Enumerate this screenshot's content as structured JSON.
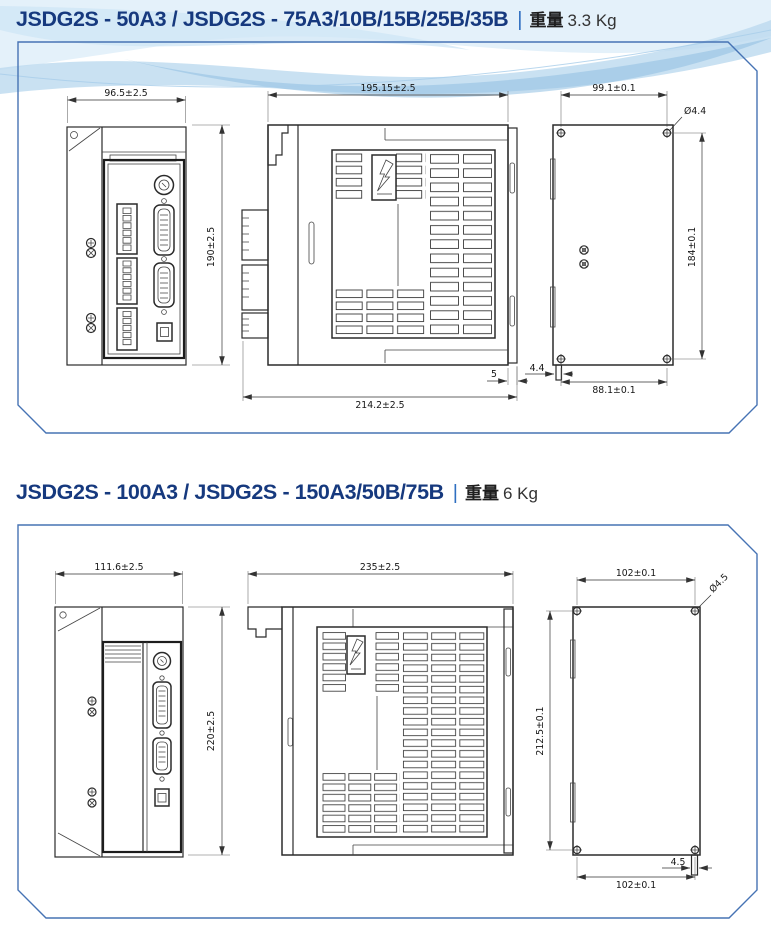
{
  "page": {
    "accent_border": "#4673b4",
    "title_color": "#16397e"
  },
  "sections": [
    {
      "title": {
        "model": "JSDG2S - 50A3 / JSDG2S - 75A3/10B/15B/25B/35B",
        "separator": "|",
        "weight_label": "重量",
        "weight_value": "3.3 Kg"
      },
      "dims": {
        "front_width": "96.5±2.5",
        "height": "190±2.5",
        "side_top_width": "195.15±2.5",
        "side_bottom_width": "214.2±2.5",
        "back_plate_offset": "5",
        "hole_pitch_width": "99.1±0.1",
        "hole_diameter": "Ø4.4",
        "hole_pitch_height": "184±0.1",
        "bottom_hole_pitch": "88.1±0.1",
        "foot_width": "4.4"
      }
    },
    {
      "title": {
        "model": "JSDG2S - 100A3 / JSDG2S - 150A3/50B/75B",
        "separator": "|",
        "weight_label": "重量",
        "weight_value": "6 Kg"
      },
      "dims": {
        "front_width": "111.6±2.5",
        "height": "220±2.5",
        "side_top_width": "235±2.5",
        "hole_pitch_width": "102±0.1",
        "hole_diameter": "Ø4.5",
        "hole_pitch_height": "212.5±0.1",
        "bottom_hole_pitch": "102±0.1",
        "foot_width": "4.5"
      }
    }
  ]
}
